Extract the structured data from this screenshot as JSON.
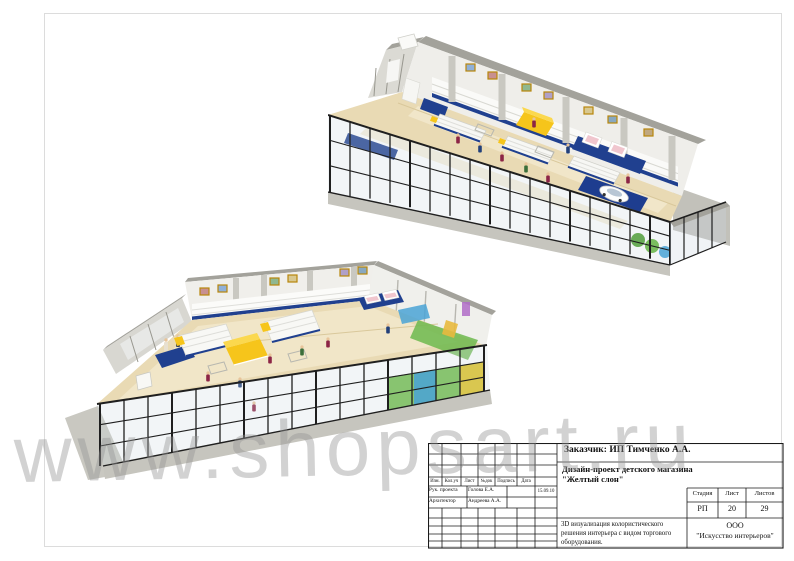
{
  "watermark": {
    "text": "www.shopsart.ru",
    "color": "#949494"
  },
  "title_block": {
    "customer": "Заказчик:  ИП Тимченко А.А.",
    "project_line1": "Дизайн-проект детского магазина",
    "project_line2": "\"Желтый слон\"",
    "columns": {
      "izm": "Изм.",
      "koluch": "Кол.уч",
      "list": "Лист",
      "ndok": "№док",
      "podpis": "Подпись",
      "data": "Дата"
    },
    "rows": [
      {
        "role": "Рук. проекта",
        "name": "Голова Е.А.",
        "signature": "",
        "date": "15.09.10"
      },
      {
        "role": "Архитектор",
        "name": "Андреева А.А.",
        "signature": "",
        "date": ""
      }
    ],
    "stage": {
      "h_stage": "Стадия",
      "h_sheet": "Лист",
      "h_total": "Листов",
      "stage": "РП",
      "sheet": "20",
      "total": "29"
    },
    "description": "3D визуализация колористического решения интерьера с видом торгового оборудования.",
    "company_line1": "ООО",
    "company_line2": "\"Искусство интерьеров\""
  },
  "palette": {
    "floor": "#e9dab4",
    "wall_top": "#a3a29b",
    "wall_face": "#efeeea",
    "end_wall": "#d8d7d1",
    "accent_yellow": "#f6c51b",
    "accent_blue": "#1e3d8f",
    "glass_frame": "#1f1f1f",
    "glass_tint": "#cdd8e0",
    "plinth": "#c6c5be",
    "mural_green": "#6db84e",
    "mural_blue": "#4aa3d6",
    "mural_yellow": "#e8c84a",
    "figure_maroon": "#8c2445",
    "figure_navy": "#22407a",
    "picture_frame": "#b8860b"
  }
}
